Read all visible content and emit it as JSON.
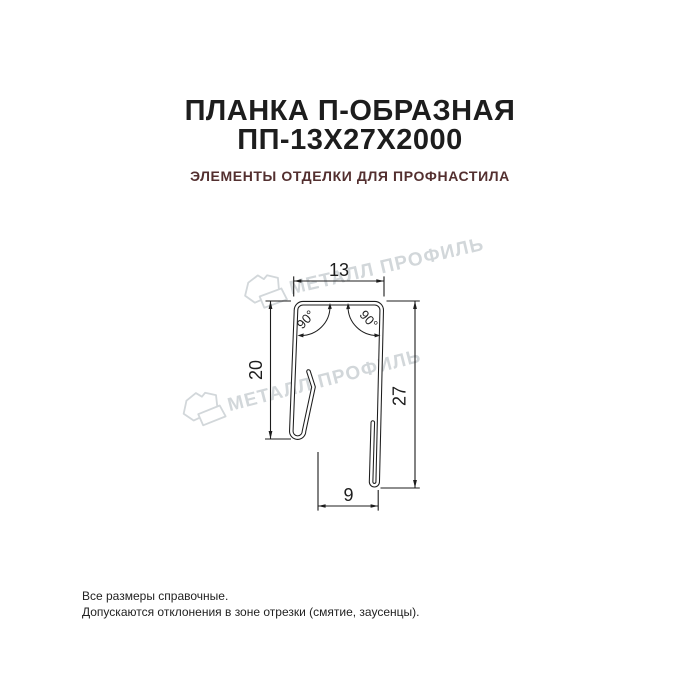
{
  "header": {
    "title_line1": "ПЛАНКА П-ОБРАЗНАЯ",
    "title_line2": "ПП-13Х27Х2000",
    "subtitle": "ЭЛЕМЕНТЫ ОТДЕЛКИ ДЛЯ ПРОФНАСТИЛА"
  },
  "drawing": {
    "dim_top_width": "13",
    "dim_left_height": "20",
    "dim_right_height": "27",
    "dim_bottom_width": "9",
    "angle_left": "90°",
    "angle_right": "90°"
  },
  "watermark": {
    "text": "МЕТАЛЛ ПРОФИЛЬ",
    "color": "#d2d7da"
  },
  "footer": {
    "note1": "Все размеры справочные.",
    "note2": "Допускаются отклонения в зоне отрезки (смятие, заусенцы)."
  },
  "colors": {
    "ink": "#1d1d1d",
    "subtitle": "#532f2f",
    "background": "#ffffff"
  }
}
